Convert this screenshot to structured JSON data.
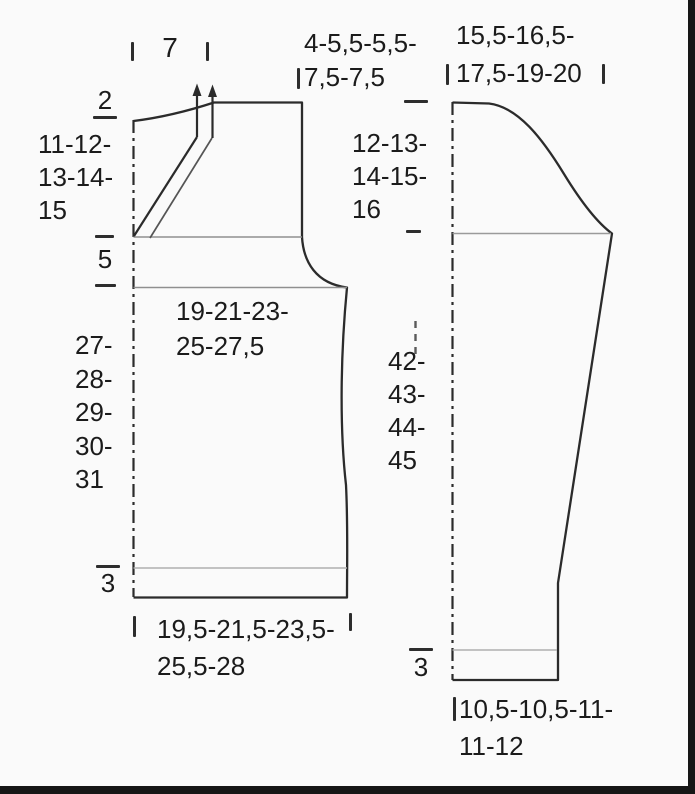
{
  "diagram": {
    "body": {
      "shoulder_width_cm": "7",
      "back_neck_height_cm": "2",
      "raglan_depth_cm": "11-12-\n13-14-\n15",
      "yoke_height_cm": "5",
      "upper_shoulder_width_cm": "4-5,5-5,5-\n7,5-7,5",
      "chest_width_cm": "19-21-23-\n25-27,5",
      "side_length_cm": "27-\n28-\n29-\n30-\n31",
      "rib_height_cm": "3",
      "hem_width_cm": "19,5-21,5-23,5-\n25,5-28"
    },
    "sleeve": {
      "upper_arm_width_cm": "15,5-16,5-\n17,5-19-20",
      "cap_height_cm": "12-13-\n14-15-\n16",
      "length_cm": "42-\n43-\n44-\n45",
      "rib_height_cm": "3",
      "cuff_width_cm": "10,5-10,5-11-\n11-12"
    }
  }
}
